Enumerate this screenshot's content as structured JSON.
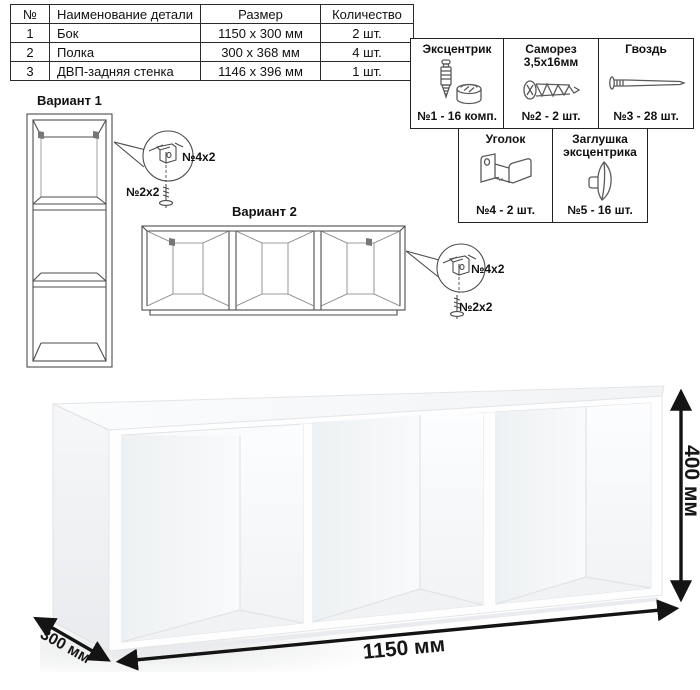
{
  "parts_table": {
    "headers": [
      "№",
      "Наименование детали",
      "Размер",
      "Количество"
    ],
    "rows": [
      [
        "1",
        "Бок",
        "1150 x 300 мм",
        "2 шт."
      ],
      [
        "2",
        "Полка",
        "300 x 368 мм",
        "4 шт."
      ],
      [
        "3",
        "ДВП-задняя стенка",
        "1146 x 396 мм",
        "1 шт."
      ]
    ]
  },
  "hardware_panel": {
    "items": [
      {
        "title_line1": "Эксцентрик",
        "title_line2": "",
        "count": "№1 - 16 комп.",
        "icon": "cam-dowel-icon"
      },
      {
        "title_line1": "Саморез",
        "title_line2": "3,5х16мм",
        "count": "№2 - 2 шт.",
        "icon": "screw-icon"
      },
      {
        "title_line1": "Гвоздь",
        "title_line2": "",
        "count": "№3 - 28 шт.",
        "icon": "nail-icon"
      },
      {
        "title_line1": "Уголок",
        "title_line2": "",
        "count": "№4 - 2 шт.",
        "icon": "corner-bracket-icon"
      },
      {
        "title_line1": "Заглушка",
        "title_line2": "эксцентрика",
        "count": "№5 - 16 шт.",
        "icon": "cam-cap-icon"
      }
    ]
  },
  "variants": {
    "variant1": {
      "label": "Вариант 1",
      "bracket_callout": "№4х2",
      "screw_callout": "№2х2"
    },
    "variant2": {
      "label": "Вариант 2",
      "bracket_callout": "№4х2",
      "screw_callout": "№2х2"
    }
  },
  "dimensions": {
    "width": "1150 мм",
    "height": "400 мм",
    "depth": "300 мм"
  },
  "colors": {
    "line": "#4d4d4d",
    "border": "#222222",
    "arrow": "#141414",
    "text": "#111111"
  }
}
